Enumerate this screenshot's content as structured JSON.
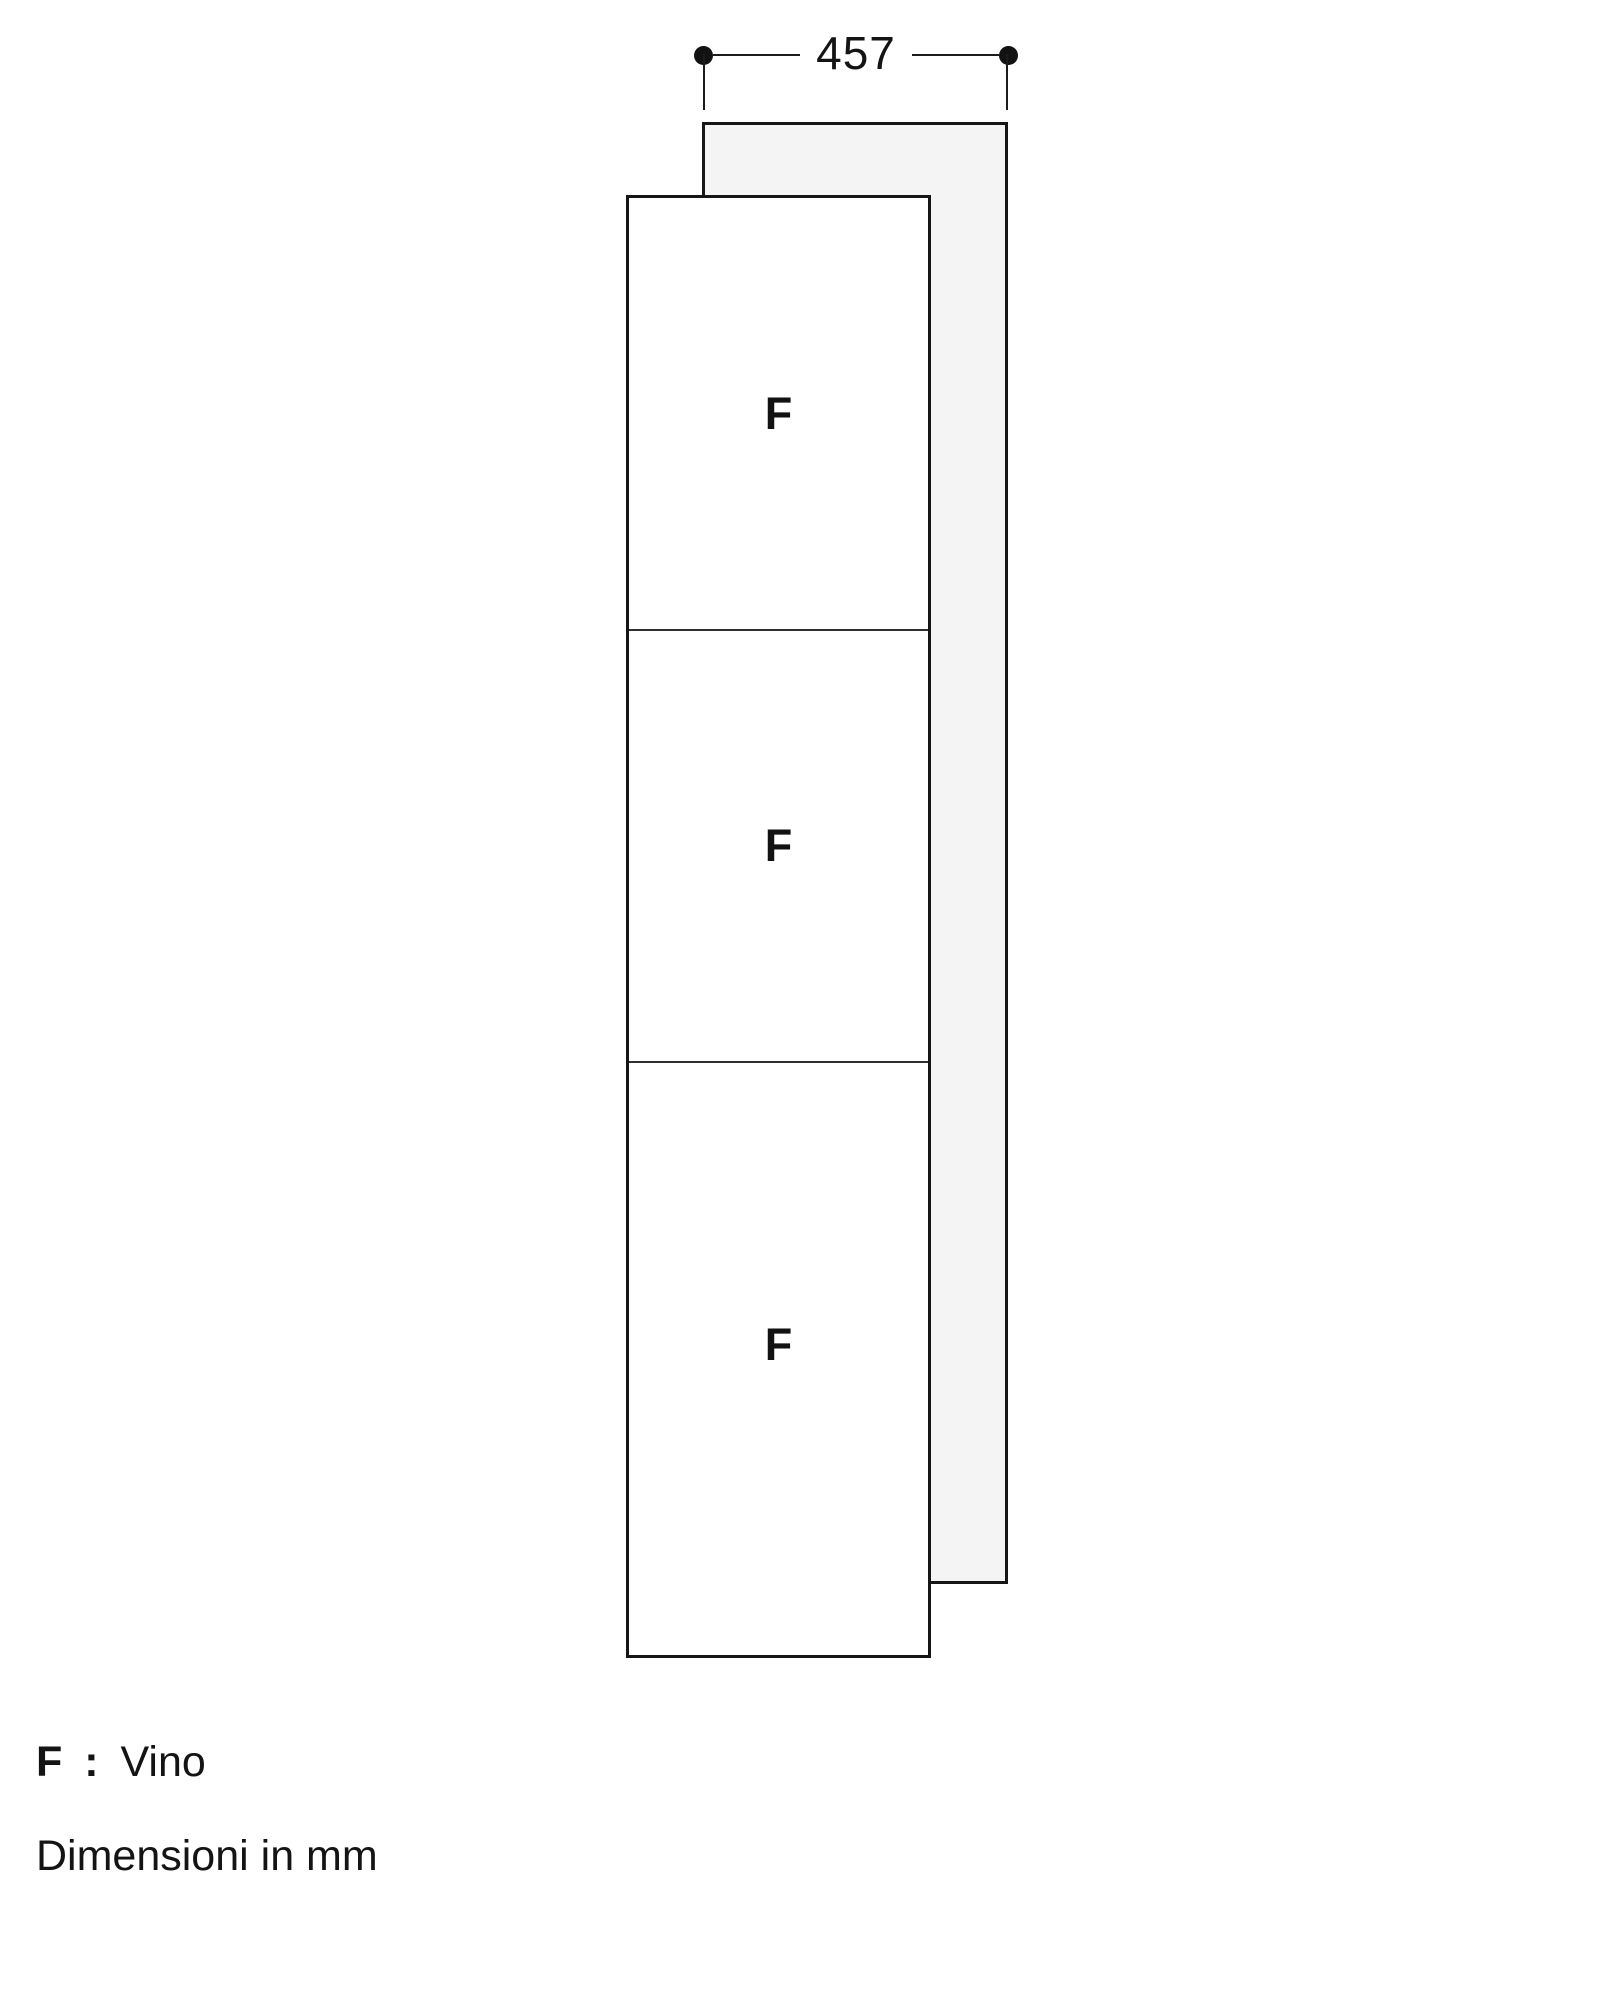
{
  "diagram": {
    "kind": "appliance-installation-drawing",
    "dimension": {
      "value": "457",
      "orientation": "horizontal",
      "measures": "width of rear panel"
    },
    "compartments": [
      {
        "label": "F"
      },
      {
        "label": "F"
      },
      {
        "label": "F"
      }
    ],
    "legend": {
      "symbol": "F",
      "separator": ":",
      "meaning": "Vino"
    },
    "units_note": "Dimensioni in mm",
    "colors": {
      "line": "#161616",
      "panel_fill": "#f4f4f4",
      "front_fill": "#ffffff",
      "background": "#ffffff",
      "text": "#141414"
    }
  }
}
